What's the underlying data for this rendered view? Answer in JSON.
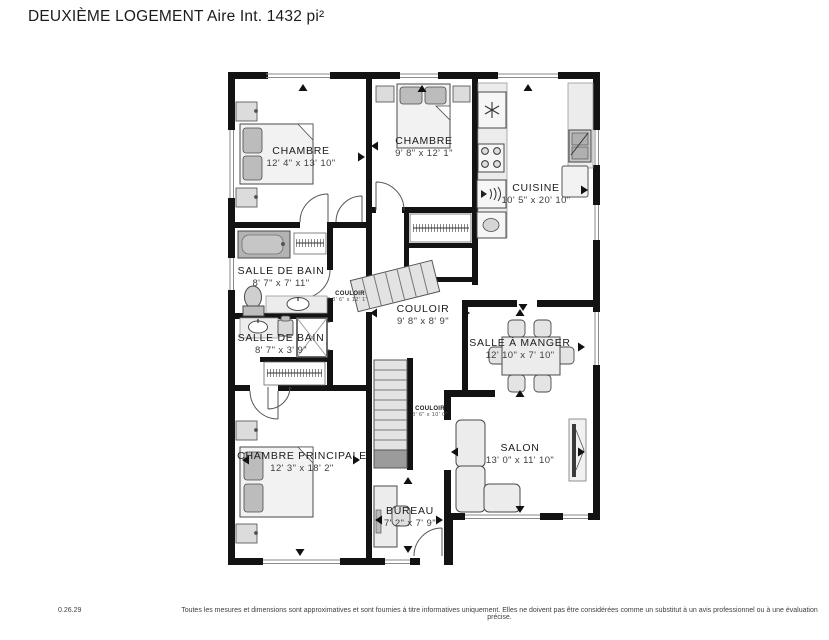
{
  "title": "DEUXIÈME LOGEMENT Aire Int. 1432 pi²",
  "rooms": [
    {
      "name": "CHAMBRE",
      "dims": "12' 4\" x 13' 10\""
    },
    {
      "name": "CHAMBRE",
      "dims": "9' 8\" x 12' 1\""
    },
    {
      "name": "CUISINE",
      "dims": "10' 5\" x 20' 10\""
    },
    {
      "name": "SALLE DE BAIN",
      "dims": "8' 7\" x 7' 11\""
    },
    {
      "name": "COULOIR",
      "dims": "3' 6\" x 12' 1\""
    },
    {
      "name": "COULOIR",
      "dims": "9' 8\" x 8' 9\""
    },
    {
      "name": "SALLE DE BAIN",
      "dims": "8' 7\" x 3' 9\""
    },
    {
      "name": "SALLE À MANGER",
      "dims": "12' 10\" x 7' 10\""
    },
    {
      "name": "COULOIR",
      "dims": "3' 6\" x 10' 0\""
    },
    {
      "name": "SALON",
      "dims": "13' 0\" x 11' 10\""
    },
    {
      "name": "CHAMBRE PRINCIPALE",
      "dims": "12' 3\" x 18' 2\""
    },
    {
      "name": "BUREAU",
      "dims": "7' 2\" x 7' 9\""
    }
  ],
  "footer": {
    "version": "0.26.29",
    "disclaimer": "Toutes les mesures et dimensions sont approximatives et sont fournies à titre informatives uniquement. Elles ne doivent pas être considérées comme un substitut à un avis professionnel ou à une évaluation précise."
  },
  "colors": {
    "wall": "#131313",
    "furniture_fill": "#ececec",
    "furniture_stroke": "#4a4a4a",
    "dark_gray": "#9b9b9b"
  }
}
